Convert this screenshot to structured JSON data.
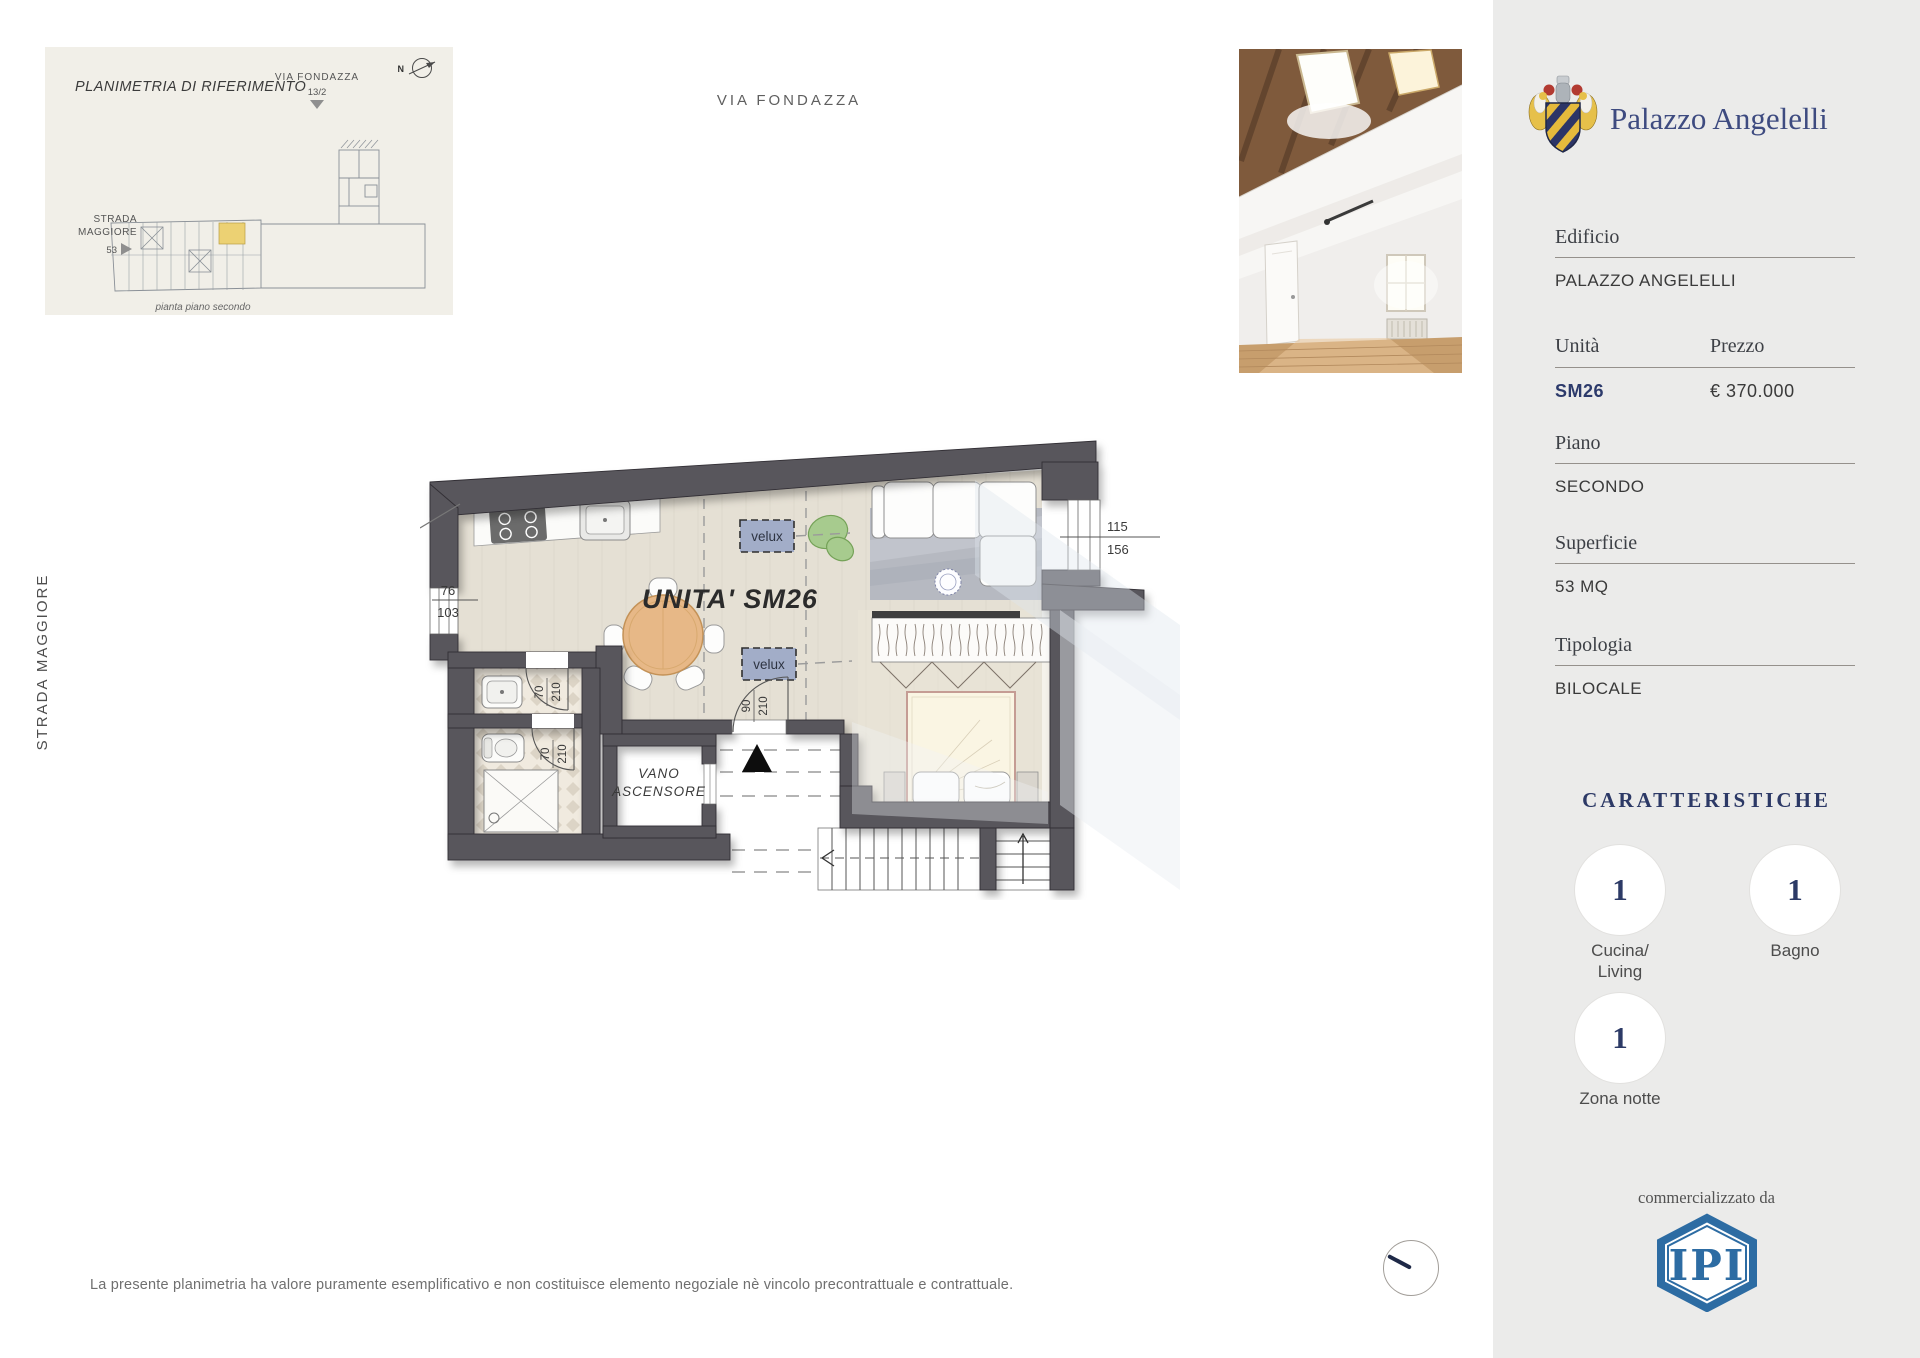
{
  "page": {
    "title_top": "VIA FONDAZZA",
    "street_left": "STRADA MAGGIORE"
  },
  "colors": {
    "accent_navy": "#2c3a6b",
    "brand_navy": "#3e4b80",
    "ipi_blue": "#2d6ca3",
    "wall_gray": "#59565b",
    "floor_beige": "#e5e0d4",
    "velux_blue": "#a2adc8",
    "unit_highlight": "#ecd173",
    "sidebar_bg": "#ebebea",
    "ref_panel_bg": "#f1efe8"
  },
  "ref_panel": {
    "title": "PLANIMETRIA DI RIFERIMENTO",
    "street_top": "VIA FONDAZZA",
    "street_top_number": "13/2",
    "north_label": "N",
    "street_left_line1": "STRADA",
    "street_left_line2": "MAGGIORE",
    "street_left_number": "53",
    "caption": "pianta piano secondo"
  },
  "plan": {
    "unit_label": "UNITA' SM26",
    "velux_label": "velux",
    "elevator_line1": "VANO",
    "elevator_line2": "ASCENSORE",
    "dim_window_left": {
      "top": "76",
      "bottom": "103"
    },
    "dim_window_right": {
      "top": "115",
      "bottom": "156"
    },
    "dim_door_bath1": {
      "top": "70",
      "bottom": "210"
    },
    "dim_door_bath2": {
      "top": "70",
      "bottom": "210"
    },
    "dim_entry": {
      "top": "90",
      "bottom": "210"
    }
  },
  "sidebar": {
    "brand": "Palazzo Angelelli",
    "edificio_label": "Edificio",
    "edificio_value": "PALAZZO ANGELELLI",
    "unita_label": "Unità",
    "unita_value": "SM26",
    "prezzo_label": "Prezzo",
    "prezzo_value": "€ 370.000",
    "piano_label": "Piano",
    "piano_value": "SECONDO",
    "superficie_label": "Superficie",
    "superficie_value": "53 MQ",
    "tipologia_label": "Tipologia",
    "tipologia_value": "BILOCALE",
    "caratteristiche_title": "CARATTERISTICHE",
    "features": [
      {
        "count": "1",
        "label_line1": "Cucina/",
        "label_line2": "Living"
      },
      {
        "count": "1",
        "label_line1": "Bagno",
        "label_line2": ""
      },
      {
        "count": "1",
        "label_line1": "Zona notte",
        "label_line2": ""
      }
    ],
    "commercial_label": "commercializzato da",
    "logo_text": "IPI"
  },
  "footer": {
    "disclaimer": "La presente planimetria ha valore puramente esemplificativo e non costituisce elemento negoziale nè vincolo precontrattuale e contrattuale."
  }
}
